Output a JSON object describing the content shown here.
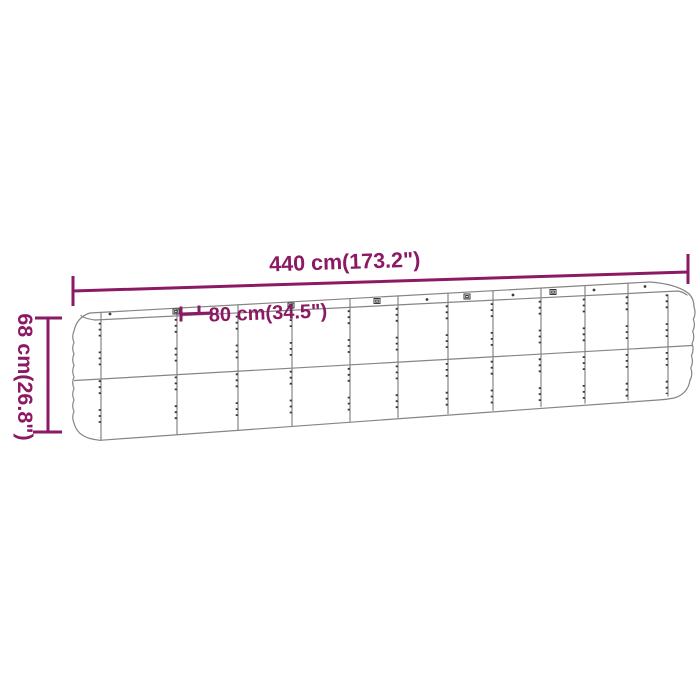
{
  "diagram": {
    "labels": {
      "width": "440 cm(173.2\")",
      "depth": "80 cm(34.5\")",
      "height": "68 cm(26.8\")"
    },
    "colors": {
      "dimension": "#8B1963",
      "outline": "#858585",
      "detail": "#3A3A3A",
      "background": "#FFFFFF"
    }
  }
}
